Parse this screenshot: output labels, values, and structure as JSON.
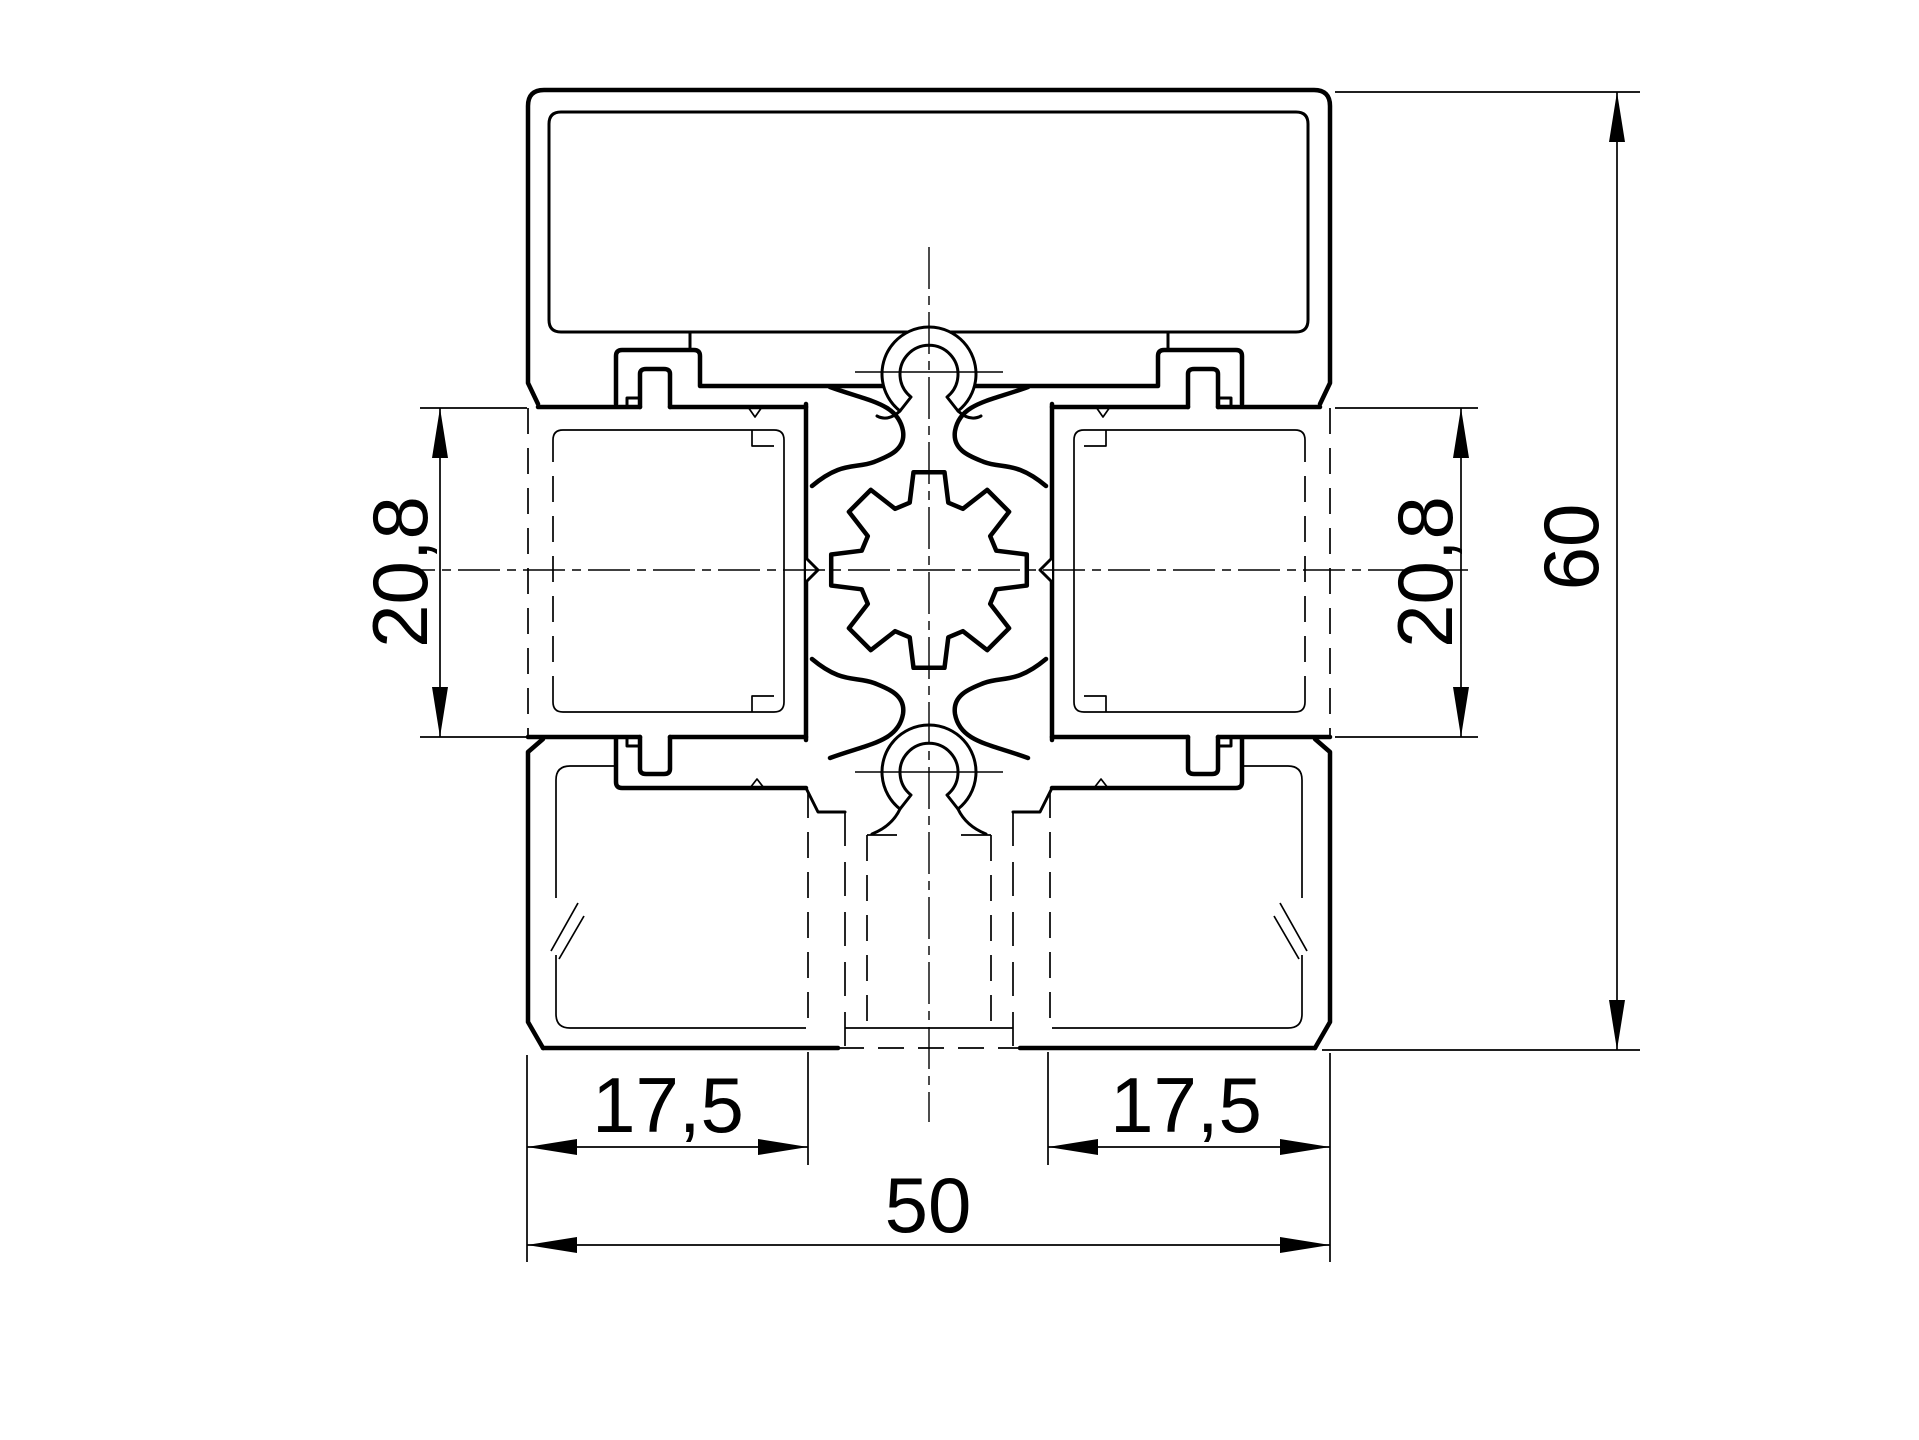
{
  "drawing": {
    "type": "technical-cross-section",
    "line_color": "#000000",
    "background_color": "#ffffff",
    "dimensions": {
      "slot_left": "20,8",
      "slot_right": "20,8",
      "height_total": "60",
      "foot_left": "17,5",
      "foot_right": "17,5",
      "width_total": "50"
    }
  }
}
